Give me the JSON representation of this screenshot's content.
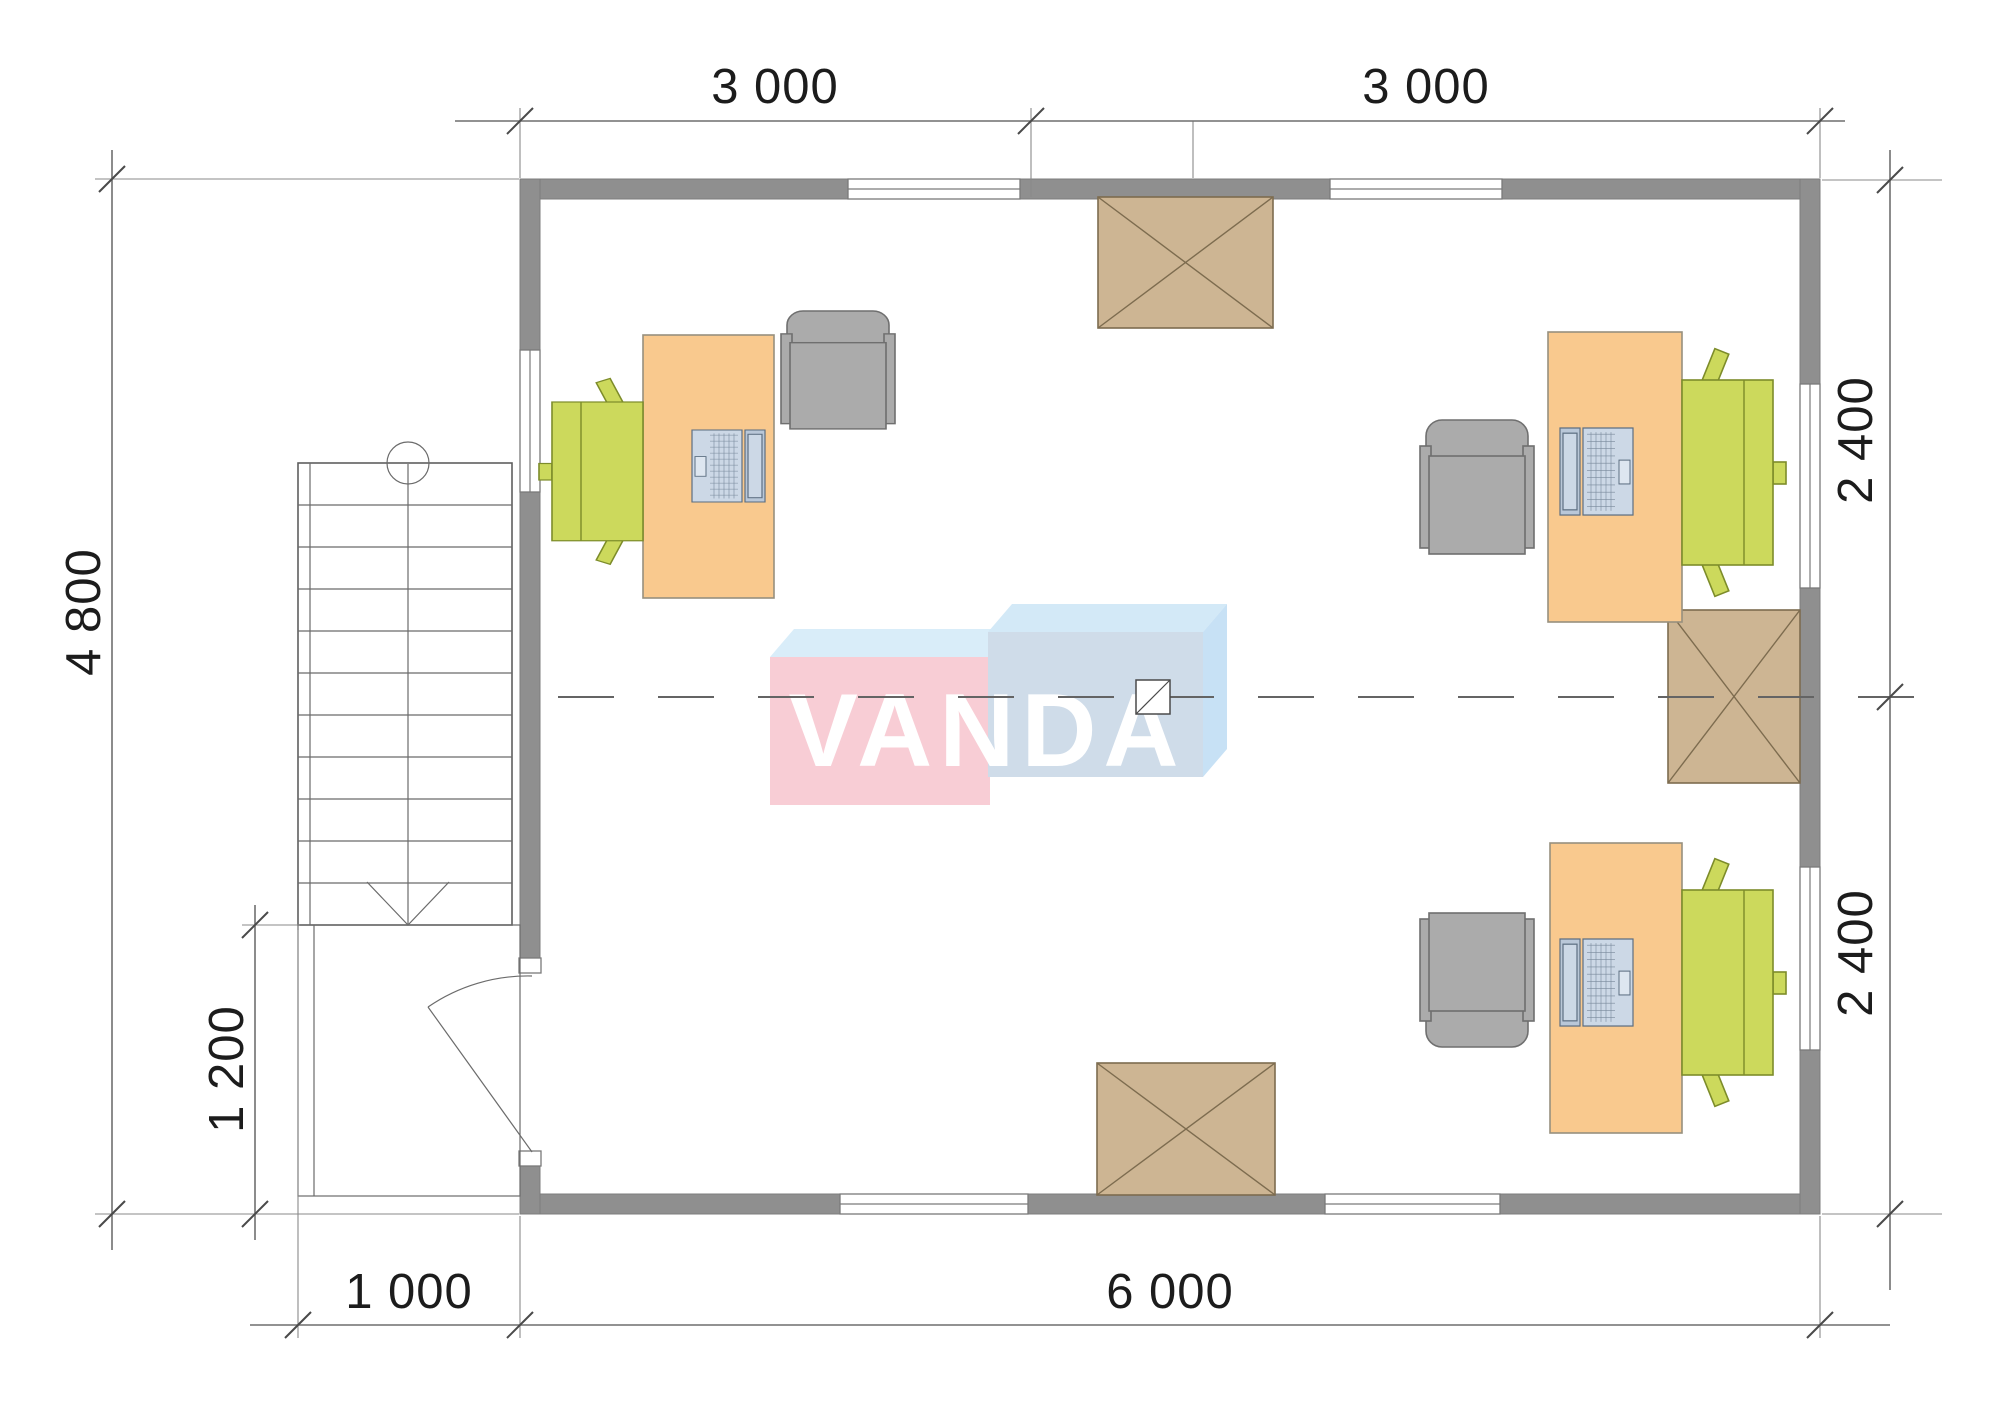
{
  "plan": {
    "title": "Office floor plan with furniture",
    "watermark": "VANDA",
    "dimensions": {
      "top": [
        "3 000",
        "3 000"
      ],
      "right": [
        "2 400",
        "2 400"
      ],
      "left": [
        "4 800"
      ],
      "porch": [
        "1 200"
      ],
      "bottom": [
        "1 000",
        "6 000"
      ]
    },
    "colors": {
      "wall": "#8f8f8f",
      "desk": "#f9c98e",
      "task_chair": "#ccd95c",
      "guest_chair": "#ababab",
      "laptop": "#ccd8e6",
      "skylight": "#cdb593",
      "logo_pink": "#f8cdd5",
      "logo_blue_box": "#cfdce9",
      "logo_light_blue": "#d3e9f7",
      "logo_text": "#ffffff",
      "dimension_text": "#1c1c1c"
    }
  }
}
